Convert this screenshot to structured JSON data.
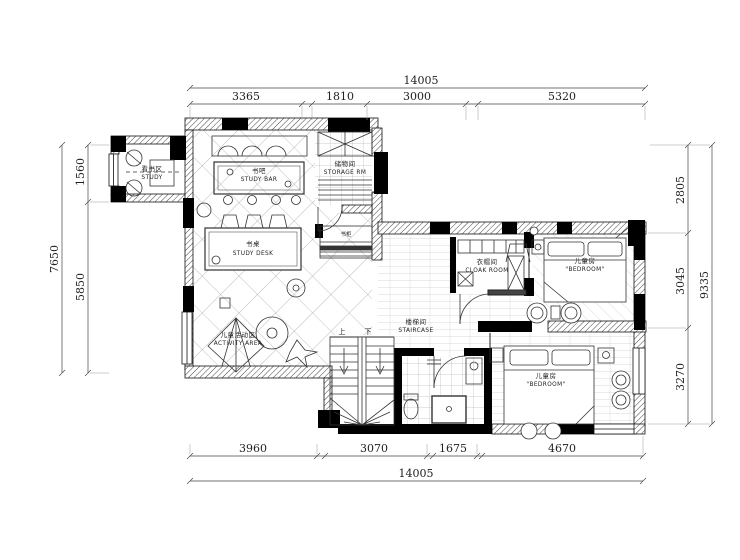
{
  "drawing": {
    "kind": "residential floor plan",
    "stair_up": "上",
    "stair_down": "下"
  },
  "dims": {
    "top": {
      "total": "14005",
      "segments": [
        "3365",
        "1810",
        "3000",
        "5320"
      ]
    },
    "bottom": {
      "total": "14005",
      "segments": [
        "3960",
        "3070",
        "1675",
        "4670"
      ]
    },
    "left": {
      "total": "7650",
      "segments": [
        "1560",
        "5850"
      ]
    },
    "right": {
      "total": "9335",
      "segments": [
        "2805",
        "3045",
        "3270"
      ]
    }
  },
  "rooms": {
    "study_nook": {
      "cn": "看书区",
      "en": "STUDY"
    },
    "study_bar": {
      "cn": "书吧",
      "en": "STUDY BAR"
    },
    "storage": {
      "cn": "储物间",
      "en": "STORAGE RM"
    },
    "study_desk": {
      "cn": "书桌",
      "en": "STUDY DESK"
    },
    "activity": {
      "cn": "儿童活动区",
      "en": "ACTIVITY AREA"
    },
    "staircase": {
      "cn": "楼梯间",
      "en": "STAIRCASE"
    },
    "bookcase": {
      "cn": "书柜",
      "en": ""
    },
    "cloak": {
      "cn": "衣帽间",
      "en": "CLOAK ROOM"
    },
    "bedroom_top": {
      "cn": "儿童房",
      "en": "\"BEDROOM\""
    },
    "bedroom_bottom": {
      "cn": "儿童房",
      "en": "\"BEDROOM\""
    }
  },
  "colors": {
    "wall": "#000000",
    "line": "#333333",
    "bg": "#ffffff"
  }
}
